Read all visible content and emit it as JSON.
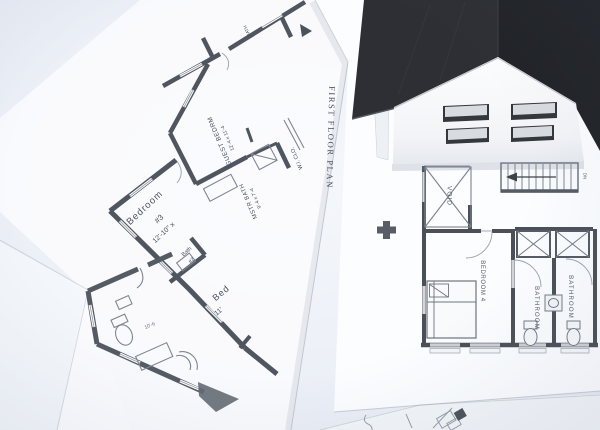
{
  "title": {
    "text": "FIRST FLOOR PLAN"
  },
  "left_plan": {
    "guest_bedrm": "GUEST BEDRM",
    "guest_bedrm_dim": "12'-4 x 11'-4",
    "mstr_bath": "MSTR BATH",
    "mstr_bath_dim": "9'-4 x 7'-4",
    "wi_clo": "W.I. CLO.",
    "bath_small": "BATH",
    "bedroom3": "Bedroom",
    "bedroom3_num": "#3",
    "bedroom3_dim": "12'-10\" x",
    "bath2_line1": "Bath",
    "bath2_line2": "#2",
    "bed_partial": "Bed",
    "bed_dim": "11'"
  },
  "bath_detail": {
    "dim": "10'-6"
  },
  "right_plan": {
    "void": "VOID",
    "dn": "DN",
    "bedroom4": "BEDROOM 4",
    "bathroom_left": "BATHROOM",
    "bathroom_right": "BATHROOM"
  },
  "colors": {
    "background": "#e7ecf5",
    "paper": "#fbfcfe",
    "wall_line": "#50565f",
    "thin_line": "#7f8691",
    "roof_dark": "#212327",
    "roof_light": "#2d2f34",
    "house_wall": "#f2f4f7",
    "label_text": "#4a5160"
  }
}
